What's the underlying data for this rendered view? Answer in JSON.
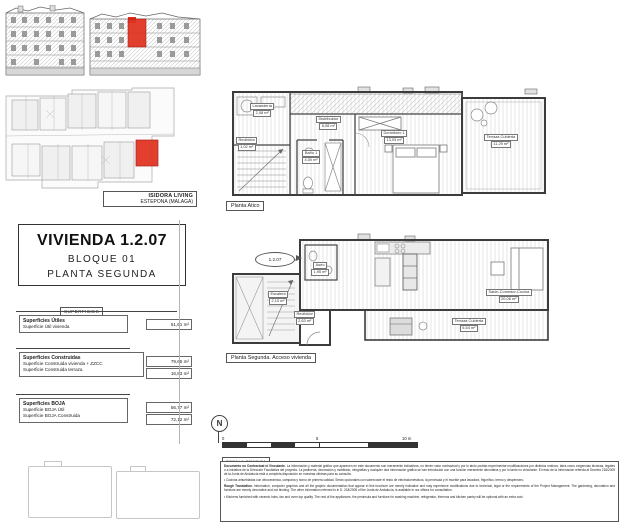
{
  "project": {
    "name": "ISIDORA LIVING",
    "location": "ESTEPONA (MALAGA)"
  },
  "title_block": {
    "unit": "VIVIENDA 1.2.07",
    "block": "BLOQUE 01",
    "floor": "PLANTA SEGUNDA"
  },
  "surfaces": {
    "header": "SUPERFICIES",
    "groups": [
      {
        "title": "Superficies Útiles",
        "rows": [
          {
            "label": "Superficie Útil vivienda",
            "value": "51,61 m²"
          }
        ]
      },
      {
        "title": "Superficies Construidas",
        "rows": [
          {
            "label": "Superficie Construida vivienda + ZZCC",
            "value": "79,65 m²"
          },
          {
            "label": "Superficie Construida terraza",
            "value": "16,83 m²"
          }
        ]
      },
      {
        "title": "Superficies BOJA",
        "rows": [
          {
            "label": "Superficie BOJA Útil",
            "value": "56,77 m²"
          },
          {
            "label": "Superficie BOJA Construida",
            "value": "72,12 m²"
          }
        ]
      }
    ]
  },
  "plans": {
    "atico": {
      "caption": "Planta Atico",
      "rooms": [
        {
          "name": "Lavandería",
          "area": "2,08 m²"
        },
        {
          "name": "Distribuidor",
          "area": "6,08 m²"
        },
        {
          "name": "Recibidor",
          "area": "1,02 m²"
        },
        {
          "name": "Baño 1",
          "area": "4,00 m²"
        },
        {
          "name": "Dormitorio 1",
          "area": "13,03 m²"
        },
        {
          "name": "Terraza Cubierta",
          "area": "11,29 m²"
        }
      ]
    },
    "segunda": {
      "caption": "Planta Segunda. Acceso vivienda",
      "unit_marker": "1.2.07",
      "rooms": [
        {
          "name": "Aseo",
          "area": "1,95 m²"
        },
        {
          "name": "Escalera",
          "area": "2,10 m²"
        },
        {
          "name": "Recibidor",
          "area": "2,63 m²"
        },
        {
          "name": "Salón-Comedor-Cocina",
          "area": "20,06 m²"
        },
        {
          "name": "Terraza Cubierta",
          "area": "5,54 m²"
        }
      ]
    }
  },
  "north_label": "N",
  "scale": {
    "ticks": [
      "0",
      "5",
      "10 m"
    ],
    "caption": "ESCALA GRAFICA"
  },
  "footer": {
    "es_lead": "Documento no Contractual ni Vinculante.",
    "es_text": "La información y material gráfico que aparecen en este documento son meramente indicativos, no tienen valor contractual y por lo tanto podrán experimentar modificaciones por distintos motivos, tales como exigencias técnicas, legales o a iniciativa de la Dirección Facultativa del proyecto. La jardinería, decoración y mobiliario, infografías y cualquier otra información gráfica se han introducido con una función meramente decorativa y por lo tanto no vinculante. El resto de la información referida al Decreto 218/2005 de la Junta de Andalucía está a completa disposición en nuestras oficinas para su consulta.",
    "es_bullet": "• Cocinas amuebladas con vitrocerámica, campana y horno de primera calidad. Serán opcionales con sobrecoste el resto de electrodomésticos, la península y el mueble para lavadora, frigorífico, termo y despensero.",
    "en_lead": "Rough Translation.",
    "en_text": "Information, computer graphics and all the graphic documentation that appear in this brochure are merely indicative and may experience modifications due to technical, legal or the requirements of the Project Management. The gardening, decoration and furniture are merely decorative and not binding. The other information referred to in D. 218/2005 of the Junta de Andalucía, is available in our offices for consultation.",
    "en_bullet": "• Kitchens furnished with ceramic hobs, fan and oven top quality. The rest of the appliances, the peninsula and furniture for washing machine, refrigerator, thermos and kitchen pantry will be optional with an extra cost."
  },
  "colors": {
    "accent_red": "#e0301e",
    "wall": "#3c3c3c",
    "light_line": "#c9c9c9"
  }
}
